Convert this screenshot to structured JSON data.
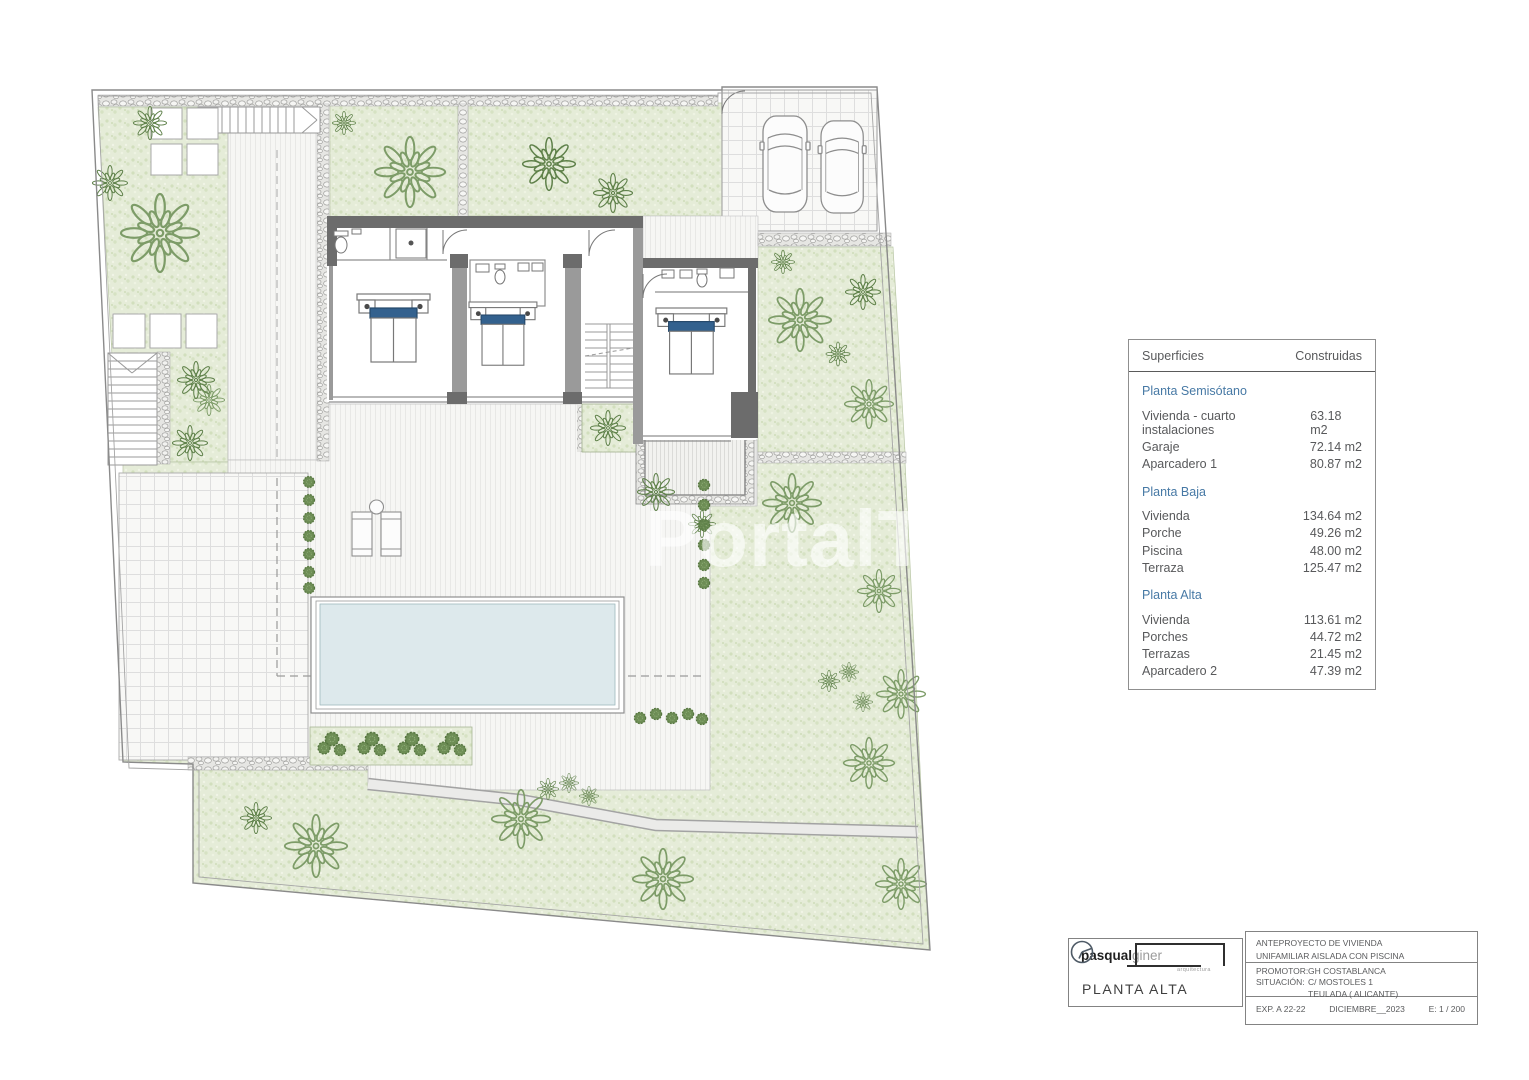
{
  "watermark": "PortalTop",
  "colors": {
    "garden_green": "#e5ecd8",
    "tree_green_light": "#7d9c68",
    "tree_green_dark": "#5e8049",
    "pool_blue": "#dde9ec",
    "wall_gray": "#6c6c6c",
    "pillow_blue": "#33618e",
    "accent_blue": "#4779a5",
    "text_gray": "#58595b"
  },
  "surfaces_table": {
    "header": {
      "left": "Superficies",
      "right": "Construidas"
    },
    "sections": [
      {
        "title": "Planta Semisótano",
        "rows": [
          {
            "label": "Vivienda - cuarto instalaciones",
            "value": "63.18 m2"
          },
          {
            "label": "Garaje",
            "value": "72.14 m2"
          },
          {
            "label": "Aparcadero 1",
            "value": "80.87 m2"
          }
        ]
      },
      {
        "title": "Planta Baja",
        "rows": [
          {
            "label": "Vivienda",
            "value": "134.64 m2"
          },
          {
            "label": "Porche",
            "value": "49.26 m2"
          },
          {
            "label": "Piscina",
            "value": "48.00 m2"
          },
          {
            "label": "Terraza",
            "value": "125.47 m2"
          }
        ]
      },
      {
        "title": "Planta Alta",
        "rows": [
          {
            "label": "Vivienda",
            "value": "113.61 m2"
          },
          {
            "label": "Porches",
            "value": "44.72 m2"
          },
          {
            "label": "Terrazas",
            "value": "21.45 m2"
          },
          {
            "label": "Aparcadero 2",
            "value": "47.39 m2"
          }
        ]
      }
    ]
  },
  "title_block": {
    "logo": {
      "bold": "pasqual",
      "light": "giner",
      "sub": "arquitectura"
    },
    "plan_name": "PLANTA ALTA",
    "project_line1": "ANTEPROYECTO  DE VIVIENDA",
    "project_line2": "UNIFAMILIAR AISLADA CON PISCINA",
    "promotor_label": "PROMOTOR:",
    "promotor": "GH COSTABLANCA",
    "situacion_label": "SITUACIÓN:",
    "situacion_line1": "C/ MOSTOLES 1",
    "situacion_line2": "TEULADA  ( ALICANTE)",
    "exp": "EXP. A 22-22",
    "date": "DICIEMBRE__2023",
    "scale": "E: 1 / 200"
  }
}
